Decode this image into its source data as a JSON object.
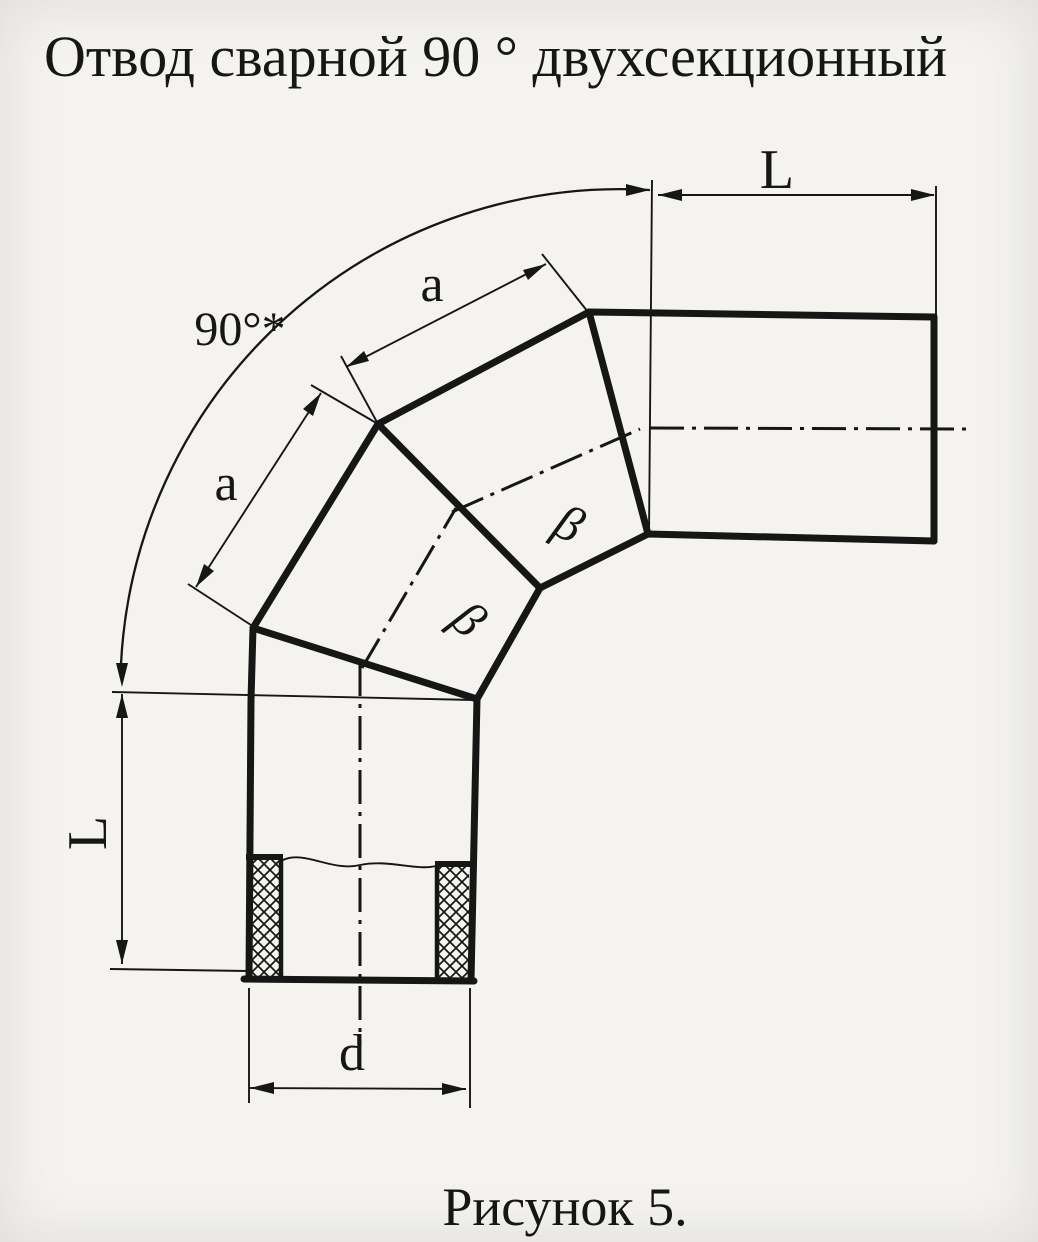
{
  "title": "Отвод сварной 90 ° двухсекционный",
  "caption": "Рисунок 5.",
  "colors": {
    "paper": "#f4f3f0",
    "ink": "#161616"
  },
  "drawing": {
    "description": "Dimensioned sketch of a welded 90-degree two-section pipe elbow with local cut-away showing wall section at the lower end",
    "labels": {
      "angle": "90°*",
      "top_length": "L",
      "left_length": "L",
      "upper_segment": "a",
      "lower_segment": "a",
      "diameter": "d",
      "upper_bevel": "β",
      "lower_bevel": "β"
    }
  }
}
